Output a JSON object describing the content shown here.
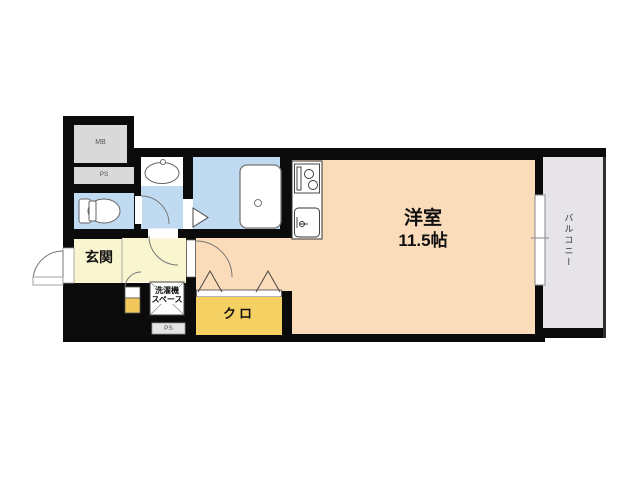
{
  "colors": {
    "wall": "#0b0b0b",
    "main_room": "#fbdcba",
    "wet_area": "#c0daf2",
    "entrance": "#f9f5cf",
    "closet": "#f5d164",
    "cabinet": "#f2c75c",
    "balcony": "#e6e4e9",
    "utility_gray": "#d9d9d9",
    "ps_box": "#e4e4e6",
    "background": "#ffffff"
  },
  "labels": {
    "main_room_name": "洋室",
    "main_room_size": "11.5帖",
    "balcony": "バルコニー",
    "entrance": "玄関",
    "closet": "クロ",
    "washer_line1": "洗濯機",
    "washer_line2": "スペース",
    "meter_box": "MB",
    "pipe_space_top": "PS",
    "pipe_space_bottom": "PS"
  }
}
